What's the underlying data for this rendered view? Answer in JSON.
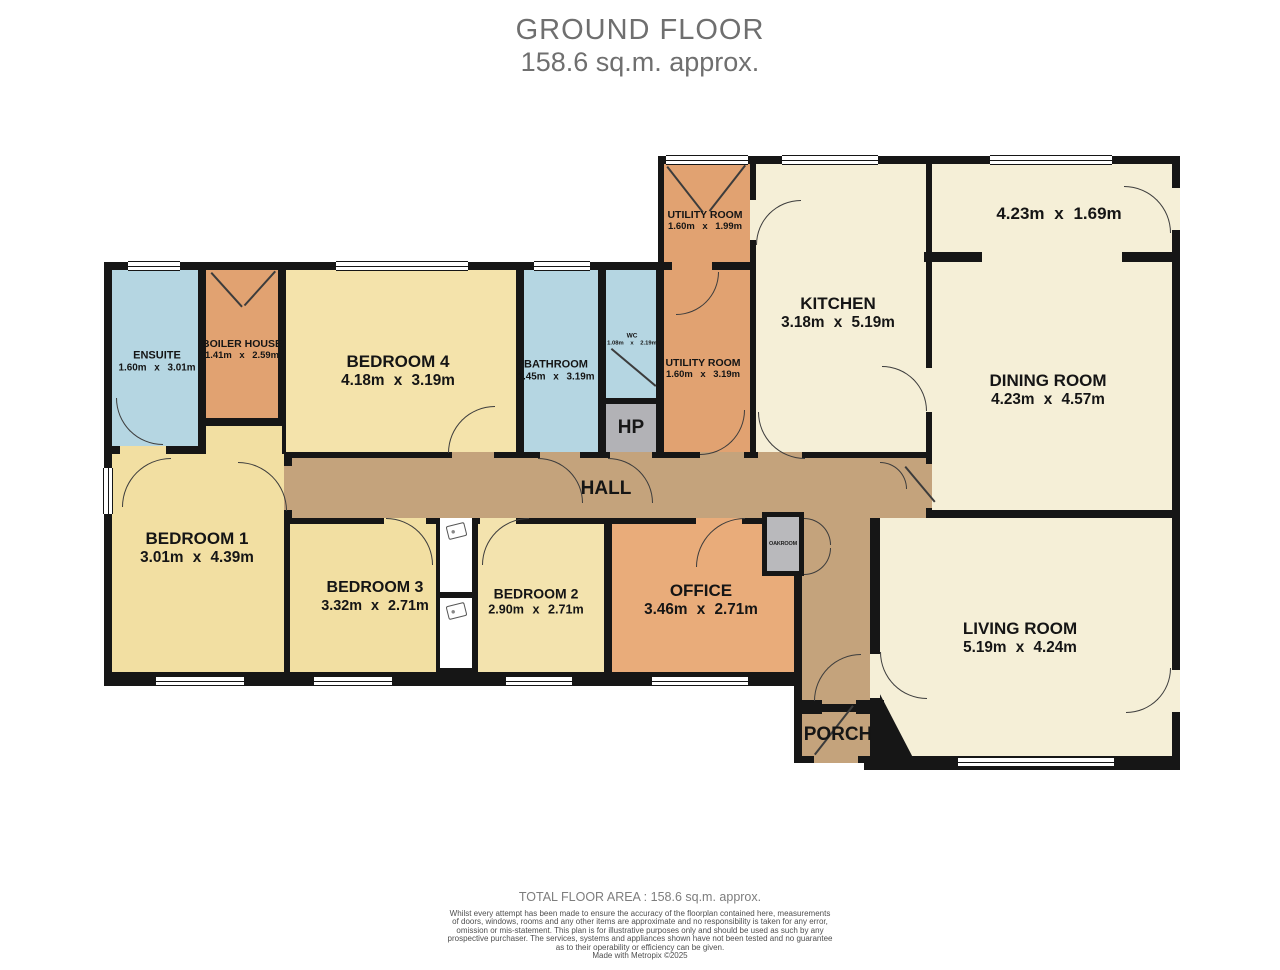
{
  "title": {
    "line1": "GROUND FLOOR",
    "line2": "158.6 sq.m. approx."
  },
  "rooms": {
    "ensuite": {
      "name": "ENSUITE",
      "dims": "1.60m x 3.01m"
    },
    "boiler_house": {
      "name": "BOILER HOUSE",
      "dims": "1.41m x 2.59m"
    },
    "bedroom4": {
      "name": "BEDROOM 4",
      "dims": "4.18m x 3.19m"
    },
    "bathroom": {
      "name": "BATHROOM",
      "dims": "1.45m x 3.19m"
    },
    "wc": {
      "name": "WC",
      "dims": "1.08m x 2.19m"
    },
    "hp": {
      "name": "HP"
    },
    "utility_room_top": {
      "name": "UTILITY ROOM",
      "dims": "1.60m x 1.99m"
    },
    "utility_room": {
      "name": "UTILITY ROOM",
      "dims": "1.60m x 3.19m"
    },
    "kitchen": {
      "name": "KITCHEN",
      "dims": "3.18m x 5.19m"
    },
    "dining_annex": {
      "dims": "4.23m x 1.69m"
    },
    "dining_room": {
      "name": "DINING ROOM",
      "dims": "4.23m x 4.57m"
    },
    "hall": {
      "name": "HALL"
    },
    "bedroom1": {
      "name": "BEDROOM 1",
      "dims": "3.01m x 4.39m"
    },
    "bedroom3": {
      "name": "BEDROOM 3",
      "dims": "3.32m x 2.71m"
    },
    "bedroom2": {
      "name": "BEDROOM 2",
      "dims": "2.90m x 2.71m"
    },
    "office": {
      "name": "OFFICE",
      "dims": "3.46m x 2.71m"
    },
    "oakroom": {
      "name": "OAKROOM"
    },
    "living_room": {
      "name": "LIVING ROOM",
      "dims": "5.19m x 4.24m"
    },
    "porch": {
      "name": "PORCH"
    }
  },
  "footer": {
    "total": "TOTAL FLOOR AREA : 158.6 sq.m. approx.",
    "disclaimer_lines": [
      "Whilst every attempt has been made to ensure the accuracy of the floorplan contained here, measurements",
      "of doors, windows, rooms and any other items are approximate and no responsibility is taken for any error,",
      "omission or mis-statement. This plan is for illustrative purposes only and should be used as such by any",
      "prospective purchaser. The services, systems and appliances shown have not been tested and no guarantee",
      "as to their operability or efficiency can be given."
    ],
    "credit": "Made with Metropix ©2025"
  },
  "colors": {
    "wall": "#161616",
    "wet_room_blue": "#b5d6e2",
    "utility_orange": "#e1a271",
    "office_orange": "#e9ac7a",
    "bedroom_yellow": "#f3e1a7",
    "living_cream": "#f5efd7",
    "hall_tan": "#c4a37c",
    "store_gray": "#b2b2b6"
  }
}
